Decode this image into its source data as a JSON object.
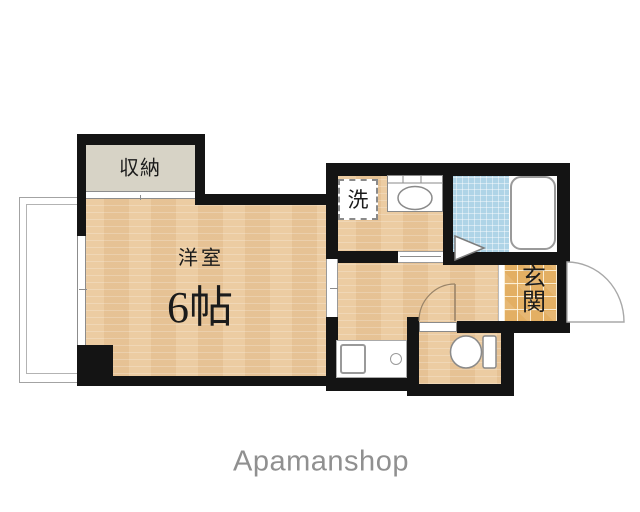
{
  "floorplan": {
    "rooms": {
      "closet": {
        "label": "収納"
      },
      "main_room": {
        "label": "洋室",
        "size": "6帖"
      },
      "laundry_space": {
        "label": "洗"
      },
      "entrance": {
        "label": "玄関"
      }
    },
    "fixtures": [
      "washbasin",
      "bathtub",
      "folding-bath-door",
      "toilet",
      "kitchen-sink",
      "kitchen-burner",
      "balcony",
      "window",
      "entrance-door",
      "toilet-door",
      "sliding-doors"
    ],
    "branding": {
      "watermark": "Apamanshop"
    },
    "colors": {
      "wall": "#141414",
      "wood_floor": "#ebc99c",
      "closet_fill": "#d7d3c6",
      "bath_tile": "#afd4e7",
      "entrance_tile": "#e3af63",
      "fixture_stroke": "#999999",
      "watermark_text": "#909090"
    }
  }
}
